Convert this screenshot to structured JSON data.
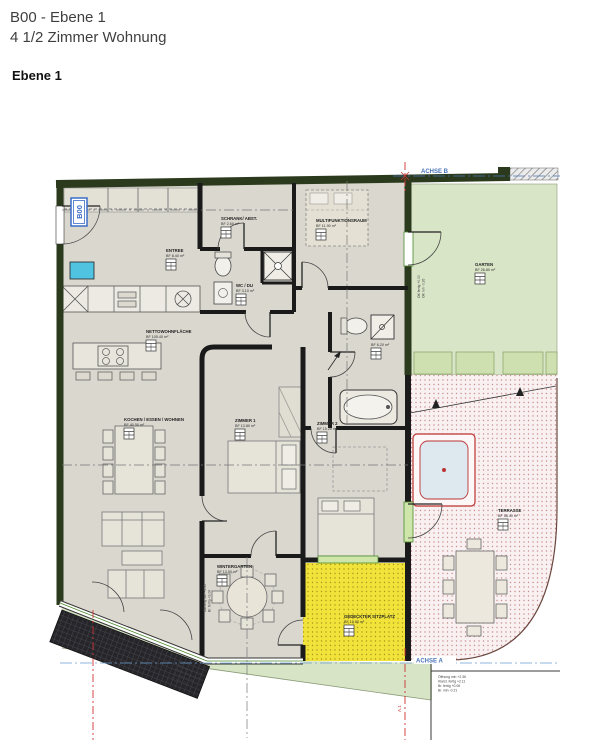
{
  "header": {
    "title_line1": "B00 - Ebene 1",
    "title_line2": "4 1/2 Zimmer Wohnung",
    "section_label": "Ebene 1"
  },
  "plan": {
    "unit_badge": "B00",
    "axes": {
      "b": "ACHSE B",
      "a": "ACHSE A",
      "red": "A.1"
    },
    "rooms": {
      "netto": {
        "name": "NETTOWOHNFLÄCHE",
        "area": "BF 105.40 m²"
      },
      "entree": {
        "name": "ENTREE",
        "area": "BF 8.40 m²"
      },
      "schrank": {
        "name": "SCHRANK/ ABST.",
        "area": "BF 2.60 m²"
      },
      "wc_du": {
        "name": "WC / DU",
        "area": "BF 3.10 m²"
      },
      "multifunktion": {
        "name": "MULTIFUNKTIONSRAUM",
        "area": "BF 11.90 m²"
      },
      "bad": {
        "name": "BAD",
        "area": "BF 6.20 m²"
      },
      "kochen": {
        "name": "KOCHEN / ESSEN / WOHNEN",
        "area": "BF 40.50 m²"
      },
      "zimmer1": {
        "name": "ZIMMER 1",
        "area": "BF 13.80 m²"
      },
      "zimmer2": {
        "name": "ZIMMER 2",
        "area": "BF 15.20 m²"
      },
      "wintergarten": {
        "name": "WINTERGARTEN",
        "area": "BF 13.50 m²"
      },
      "garten": {
        "name": "GARTEN",
        "area": "BF 26.80 m²"
      },
      "terrasse": {
        "name": "TERRASSE",
        "area": "BF 58.40 m²"
      },
      "sitzplatz": {
        "name": "GEDECKTER SITZPLATZ",
        "area": "BF 19.80 m²"
      }
    },
    "annotations": {
      "garten_dim1": "OK fertig +0.00",
      "garten_dim2": "OK roh -0.26",
      "window_dim1": "Öffnung min +2.35",
      "window_dim2": "Br. fertig +3.06",
      "facade_block1": [
        "Öffnung min +2.35",
        "Klarst. fertig +2.11",
        "Br. fertig +3.06",
        "Br. roh +3.21"
      ],
      "facade_block2": [
        "Öffnung min +2.36",
        "Klarst. fertig +2.11",
        "Br. fertig +0.06",
        "Br. min -0.21"
      ]
    },
    "colors": {
      "wall_green": "#2b3a1c",
      "floor": "#dad7cf",
      "garden": "#d9e5c7",
      "lawn": "#d7e4c5",
      "axis_blue": "#4a74b8",
      "axis_red": "#cc3333",
      "badge_blue": "#3a6cc8",
      "water": "#4fc3e0",
      "wall_black": "#1a1a1a",
      "furniture": "#e6e3d9"
    }
  }
}
